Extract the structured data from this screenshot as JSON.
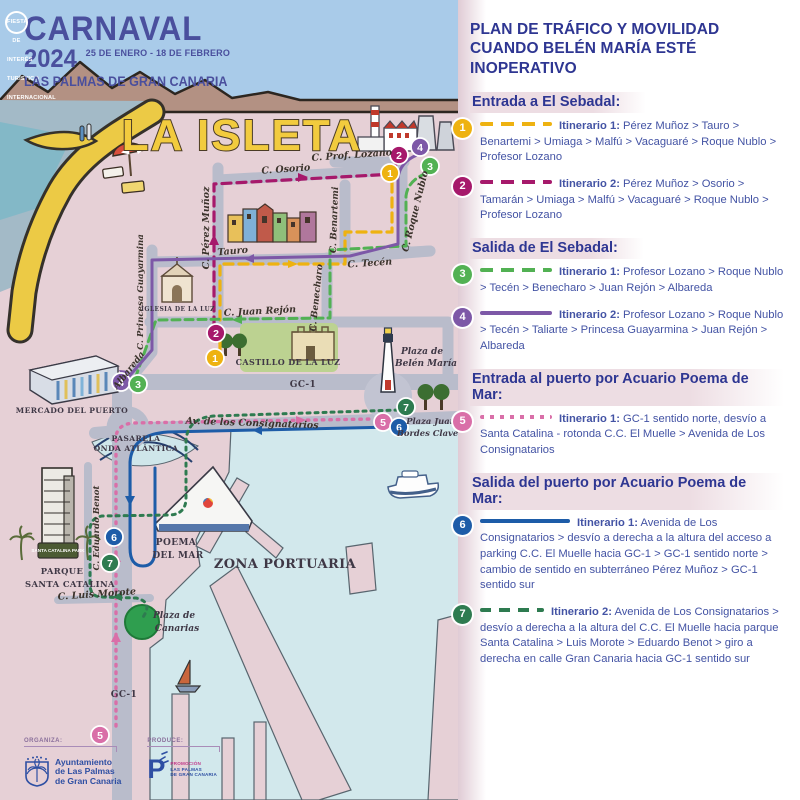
{
  "colors": {
    "sky": "#a9cbe9",
    "land": "#e6d0d6",
    "road": "#b9bccb",
    "harbor_water": "#d2e8ec",
    "sea": "#a3bac7",
    "beach": "#ecca45",
    "panel_title": "#2e3692",
    "panel_text": "#4353a4",
    "heading_highlight": "#eddde3",
    "route1": "#eeb211",
    "route2": "#a6196b",
    "route3": "#52b153",
    "route4": "#7d58a7",
    "route5": "#d96fa8",
    "route6": "#1d5ca8",
    "route7": "#2e7b50"
  },
  "header": {
    "title": "CARNAVAL",
    "year": "2024",
    "dates": "25 DE ENERO - 18 DE FEBRERO",
    "badge": "FIESTA DE INTERÉS TURÍSTICO INTERNACIONAL",
    "city": "LAS PALMAS DE GRAN CANARIA"
  },
  "map": {
    "title": "LA ISLETA",
    "streets": [
      "C. Prof. Lozano",
      "C. Osorio",
      "C. Pérez Muñoz",
      "C. Roque Nublo",
      "C. Benartemi",
      "Tauro",
      "C. Tecén",
      "C. Benecharo",
      "C. Juan Rejón",
      "C. Princesa Guayarmina",
      "Albareda",
      "GC-1",
      "Av. de los Consignatarios",
      "C. Eduardo Benot",
      "C. Luis Morote",
      "GC-1"
    ],
    "places": [
      "IGLESIA DE LA LUZ",
      "CASTILLO DE LA LUZ",
      "Plaza de",
      "Belén María",
      "MERCADO DEL PUERTO",
      "PASARELA",
      "ONDA ATLÁNTICA",
      "Plaza Juan",
      "Bordes Claverie",
      "POEMA",
      "DEL MAR",
      "PARQUE",
      "SANTA CATALINA",
      "SANTA CATALINA PARK",
      "ZONA PORTUARIA",
      "Plaza de",
      "Canarias"
    ],
    "markers": [
      {
        "n": "1",
        "x": 390,
        "y": 173,
        "c": "#eeb211"
      },
      {
        "n": "2",
        "x": 399,
        "y": 155,
        "c": "#a6196b"
      },
      {
        "n": "3",
        "x": 430,
        "y": 166,
        "c": "#52b153"
      },
      {
        "n": "4",
        "x": 420,
        "y": 147,
        "c": "#7d58a7"
      },
      {
        "n": "2",
        "x": 216,
        "y": 333,
        "c": "#a6196b"
      },
      {
        "n": "1",
        "x": 215,
        "y": 358,
        "c": "#eeb211"
      },
      {
        "n": "4",
        "x": 121,
        "y": 382,
        "c": "#7d58a7"
      },
      {
        "n": "3",
        "x": 138,
        "y": 384,
        "c": "#52b153"
      },
      {
        "n": "7",
        "x": 406,
        "y": 407,
        "c": "#2e7b50"
      },
      {
        "n": "5",
        "x": 383,
        "y": 422,
        "c": "#d96fa8"
      },
      {
        "n": "6",
        "x": 399,
        "y": 427,
        "c": "#1d5ca8"
      },
      {
        "n": "6",
        "x": 114,
        "y": 537,
        "c": "#1d5ca8"
      },
      {
        "n": "7",
        "x": 110,
        "y": 563,
        "c": "#2e7b50"
      },
      {
        "n": "5",
        "x": 100,
        "y": 735,
        "c": "#d96fa8"
      }
    ]
  },
  "panel": {
    "title": "PLAN DE TRÁFICO Y MOVILIDAD CUANDO BELÉN MARÍA ESTÉ INOPERATIVO",
    "sections": [
      {
        "heading": "Entrada a El Sebadal:",
        "items": [
          {
            "n": "1",
            "label": "Itinerario 1:",
            "text": "Pérez Muñoz > Tauro > Benartemi > Umiaga > Malfú > Vacaguaré > Roque Nublo > Profesor Lozano"
          },
          {
            "n": "2",
            "label": "Itinerario 2:",
            "text": "Pérez Muñoz > Osorio > Tamarán > Umiaga > Malfú > Vacaguaré > Roque Nublo > Profesor Lozano"
          }
        ]
      },
      {
        "heading": "Salida de El Sebadal:",
        "items": [
          {
            "n": "3",
            "label": "Itinerario 1:",
            "text": "Profesor Lozano > Roque Nublo > Tecén > Benecharo > Juan Rejón > Albareda"
          },
          {
            "n": "4",
            "label": "Itinerario 2:",
            "text": "Profesor Lozano > Roque Nublo > Tecén > Taliarte > Princesa Guayarmina > Juan Rejón > Albareda"
          }
        ]
      },
      {
        "heading": "Entrada al puerto por Acuario Poema de Mar:",
        "items": [
          {
            "n": "5",
            "label": "Itinerario 1:",
            "text": "GC-1 sentido norte, desvío a Santa Catalina - rotonda C.C. El Muelle > Avenida de Los Consignatarios"
          }
        ]
      },
      {
        "heading": "Salida del puerto por Acuario Poema de Mar:",
        "items": [
          {
            "n": "6",
            "label": "Itinerario 1:",
            "text": "Avenida de Los Consignatarios > desvío a derecha a la altura del acceso a parking C.C. El Muelle hacia GC-1 > GC-1 sentido norte > cambio de sentido en subterráneo Pérez Muñoz > GC-1 sentido sur"
          },
          {
            "n": "7",
            "label": "Itinerario 2:",
            "text": "Avenida de Los Consignatarios > desvío a derecha a la altura del C.C. El Muelle hacia parque Santa Catalina > Luis Morote > Eduardo Benot > giro a derecha en calle Gran Canaria hacia GC-1 sentido sur"
          }
        ]
      }
    ]
  },
  "footer": {
    "organiza": "ORGANIZA:",
    "organiza_name_1": "Ayuntamiento",
    "organiza_name_2": "de Las Palmas",
    "organiza_name_3": "de Gran Canaria",
    "produce": "PRODUCE:",
    "produce_logo": "P",
    "produce_name_1": "PROMOCIÓN",
    "produce_name_2": "LAS PALMAS",
    "produce_name_3": "DE GRAN CANARIA"
  }
}
